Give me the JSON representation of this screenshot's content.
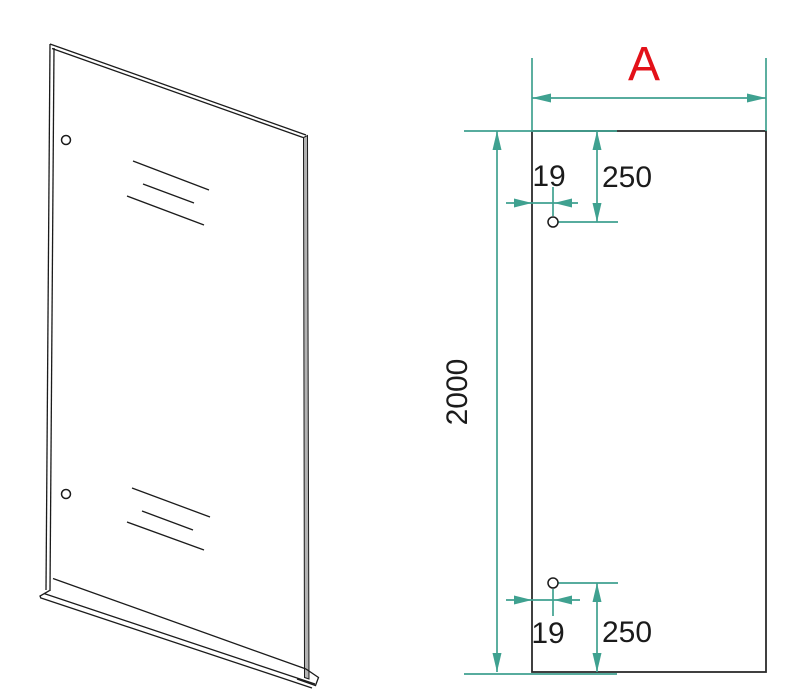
{
  "labels": {
    "width": "A",
    "height": "2000",
    "top_hole_top_offset": "250",
    "top_hole_edge_inset": "19",
    "bottom_hole_bottom_offset": "250",
    "bottom_hole_edge_inset": "19"
  },
  "colors": {
    "dimension_lines": "#3fa190",
    "width_label": "#e31119",
    "drawing_lines": "#1b1b1b",
    "background": "#ffffff"
  }
}
